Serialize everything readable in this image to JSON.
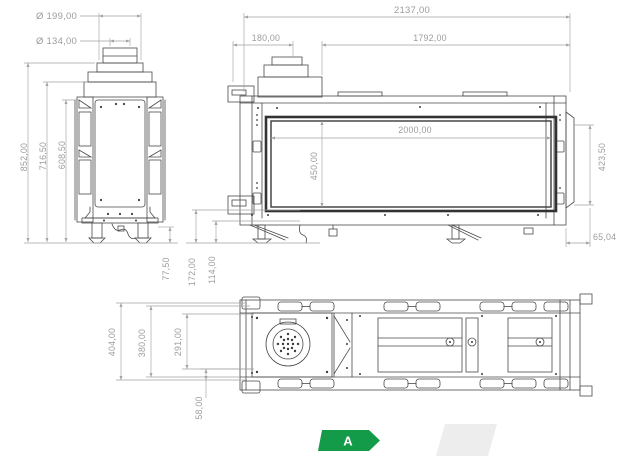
{
  "views": {
    "side": {
      "dimensions": {
        "flue_outer_diameter": "Ø 199,00",
        "flue_inner_diameter": "Ø 134,00",
        "total_height": "852,00",
        "body_height": "716,50",
        "frame_height": "608,50",
        "leg_height": "77,50"
      }
    },
    "front": {
      "dimensions": {
        "total_width": "2137,00",
        "flue_section_width": "180,00",
        "body_width": "1792,00",
        "opening_width": "2000,00",
        "opening_height": "450,00",
        "side_height": "423,50",
        "side_offset": "65,04",
        "connection_height": "172,00",
        "burner_height": "114,00"
      }
    },
    "plan": {
      "dimensions": {
        "total_depth": "404,00",
        "body_depth": "380,00",
        "inner_depth": "291,00",
        "bottom_offset": "58,00"
      }
    }
  },
  "energy_label": {
    "class_letter": "A",
    "arrow_color": "#149b4a"
  },
  "colors": {
    "line": "#4a4a4a",
    "dimension": "#9c9c9c",
    "background": "#ffffff",
    "watermark": "#ededed"
  }
}
